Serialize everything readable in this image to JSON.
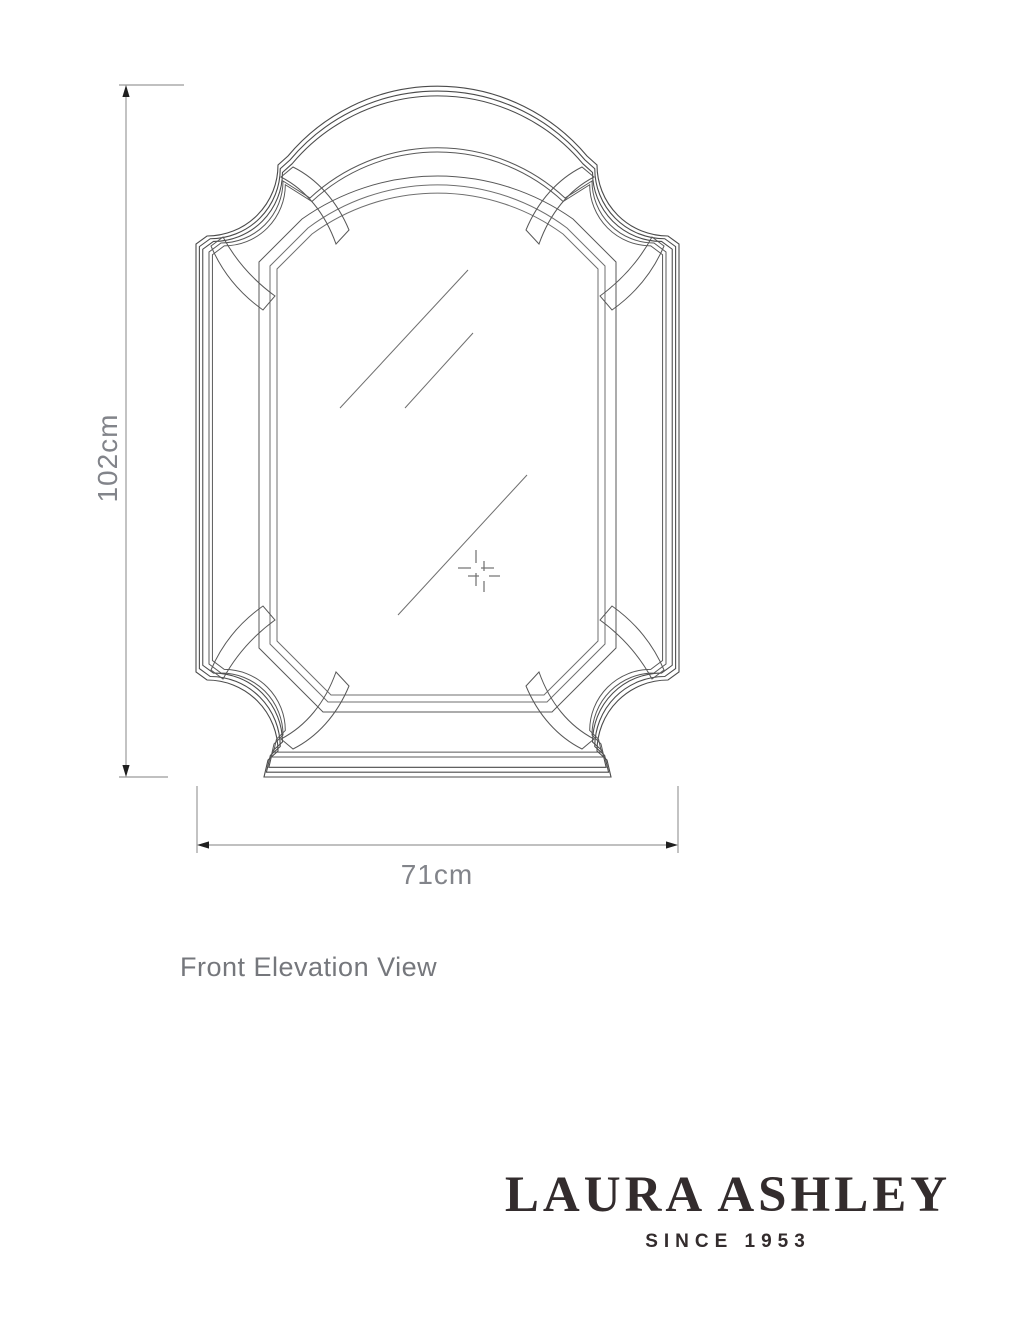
{
  "page": {
    "background": "#ffffff",
    "width": 1024,
    "height": 1331
  },
  "drawing": {
    "type": "technical-line-drawing",
    "subject": "arched wall mirror with scalloped corners, front view",
    "view_caption": "Front Elevation View"
  },
  "dimensions": {
    "height": {
      "label": "102cm"
    },
    "width": {
      "label": "71cm"
    }
  },
  "brand": {
    "name": "LAURA ASHLEY",
    "tagline": "SINCE 1953",
    "color": "#332c2d"
  },
  "colors": {
    "outline": "#4b4b4b",
    "inner_outline": "#585858",
    "glass_detail": "#6f6f6f",
    "dimension_line": "#9b9b9b",
    "dimension_arrow": "#1f1f1f",
    "label_text": "#82848a",
    "caption_text": "#75777c"
  }
}
